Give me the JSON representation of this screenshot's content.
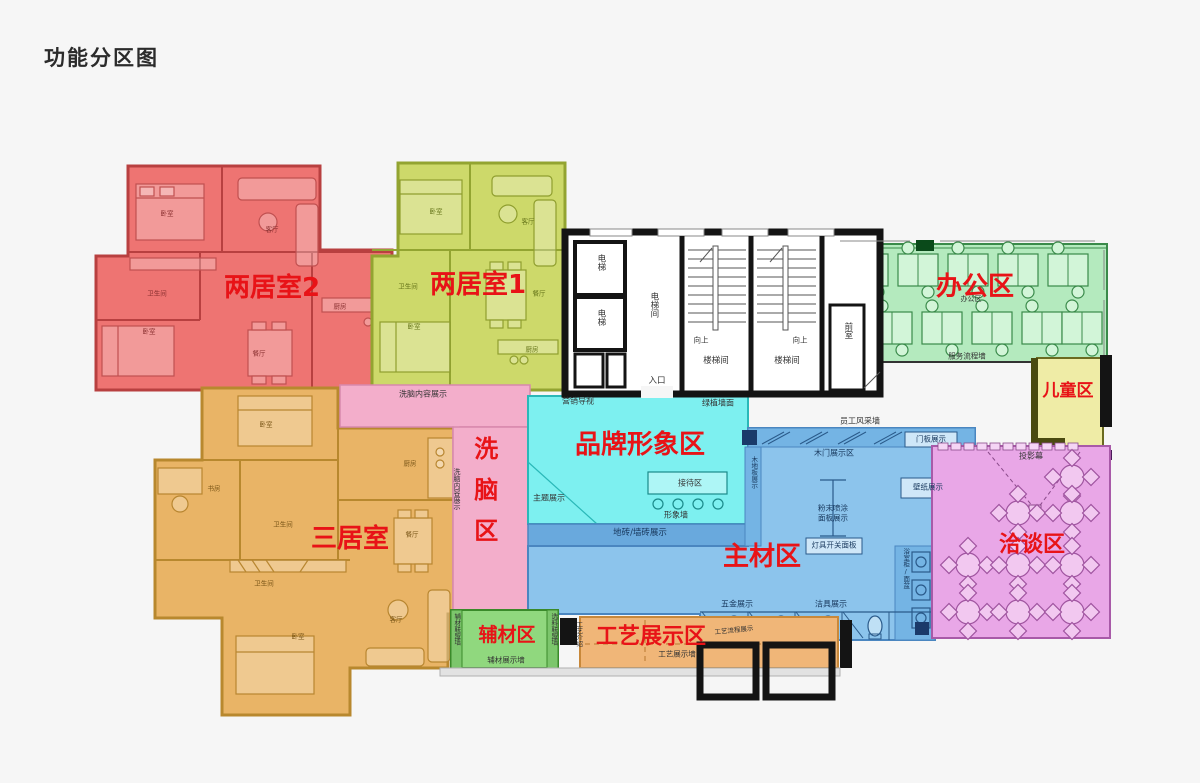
{
  "title": "功能分区图",
  "zones": {
    "twobed2": {
      "label": "两居室2",
      "color": "#ee7472"
    },
    "twobed1": {
      "label": "两居室1",
      "color": "#cdd96a"
    },
    "threebed": {
      "label": "三居室",
      "color": "#e9b466"
    },
    "brainwash": {
      "label": "洗脑区",
      "color": "#f3aecb"
    },
    "brand": {
      "label": "品牌形象区",
      "color": "#7df0f0"
    },
    "main": {
      "label": "主材区",
      "color": "#8cc4ec"
    },
    "office": {
      "label": "办公区",
      "color": "#b4eabe"
    },
    "kids": {
      "label": "儿童区",
      "color": "#efeca6"
    },
    "negotiation": {
      "label": "洽谈区",
      "color": "#e9a7e7"
    },
    "aux": {
      "label": "辅材区",
      "color": "#90d87e"
    },
    "craft": {
      "label": "工艺展示区",
      "color": "#f0b678"
    }
  },
  "core": {
    "elevator": "电梯",
    "elevator_hall": "电梯间",
    "stairwell": "楼梯间",
    "up": "向上",
    "front_room": "前室",
    "entrance": "入口"
  },
  "features": {
    "brainwash_display_h": "洗脑内容展示",
    "brainwash_display_v": "洗脑内容展示",
    "marketing_sign": "营销导视",
    "green_wall": "绿植墙面",
    "theme_display": "主题展示",
    "reception": "接待区",
    "image_wall": "形象墙",
    "tile_display": "地砖/墙砖展示",
    "staff_wall": "员工风采墙",
    "door_panel": "门板展示",
    "wood_door_area": "木门展示区",
    "wood_floor": "木地板展示",
    "wallpaper": "壁纸展示",
    "powder_line1": "粉末喷涂",
    "powder_line2": "面板展示",
    "switch_panel": "灯具开关面板",
    "hardware": "五金展示",
    "sanitary": "洁具展示",
    "bath_cabinet": "浴室柜/面盆",
    "projector_screen": "投影幕",
    "service_wall": "服务流程墙",
    "office_small": "办公区",
    "aux_left_wall": "辅材联盟墙",
    "aux_right_wall": "选料联盟墙",
    "aux_bottom_wall": "辅材展示墙",
    "craft_intro": "工艺介绍",
    "craft_wall": "工艺展示墙",
    "craft_process": "工艺流程展示"
  },
  "rooms": {
    "bedroom": "卧室",
    "living": "客厅",
    "bath": "卫生间",
    "dining": "餐厅",
    "kitchen": "厨房",
    "study": "书房"
  }
}
